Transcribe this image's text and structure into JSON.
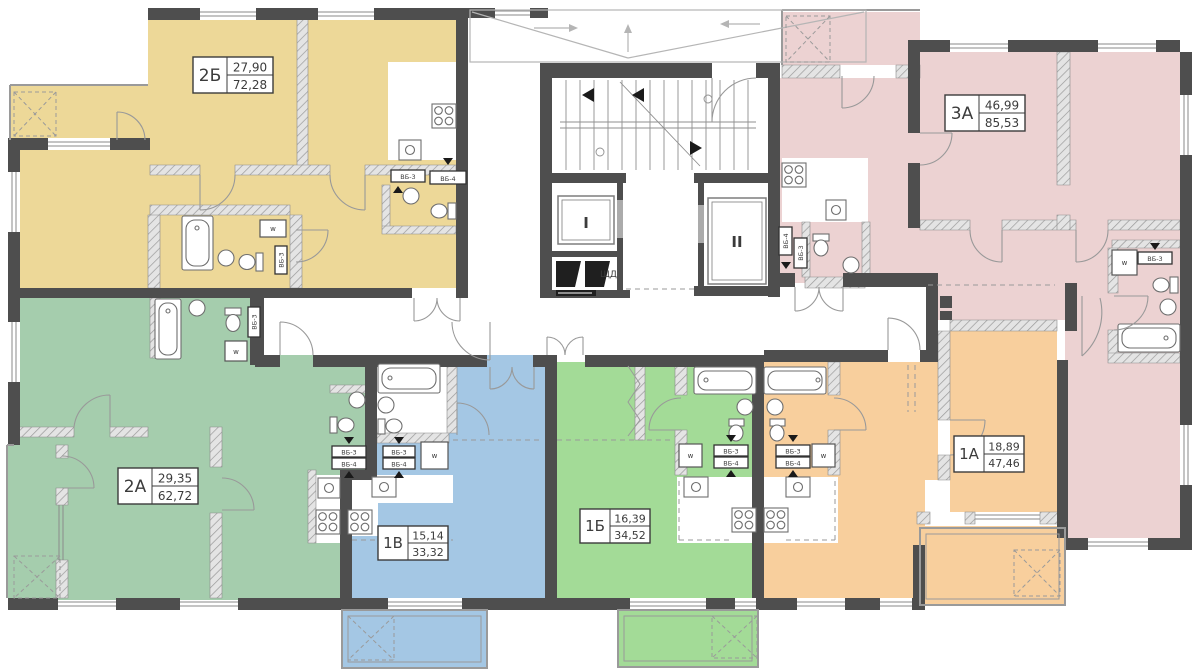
{
  "apartments": [
    {
      "code": "2Б",
      "living_area": "27,90",
      "total_area": "72,28",
      "color": "#EDD898"
    },
    {
      "code": "3А",
      "living_area": "46,99",
      "total_area": "85,53",
      "color": "#ECD2D2"
    },
    {
      "code": "2А",
      "living_area": "29,35",
      "total_area": "62,72",
      "color": "#A5CDAD"
    },
    {
      "code": "1В",
      "living_area": "15,14",
      "total_area": "33,32",
      "color": "#A4C7E4"
    },
    {
      "code": "1Б",
      "living_area": "16,39",
      "total_area": "34,52",
      "color": "#A3DB97"
    },
    {
      "code": "1А",
      "living_area": "18,89",
      "total_area": "47,46",
      "color": "#F8CF9D"
    }
  ],
  "core": {
    "elevator_left": "I",
    "elevator_right": "II",
    "switchboard": "ЩД"
  },
  "labels": {
    "vent_block_3": "ВБ-3",
    "vent_block_4": "ВБ-4",
    "washer": "w"
  }
}
